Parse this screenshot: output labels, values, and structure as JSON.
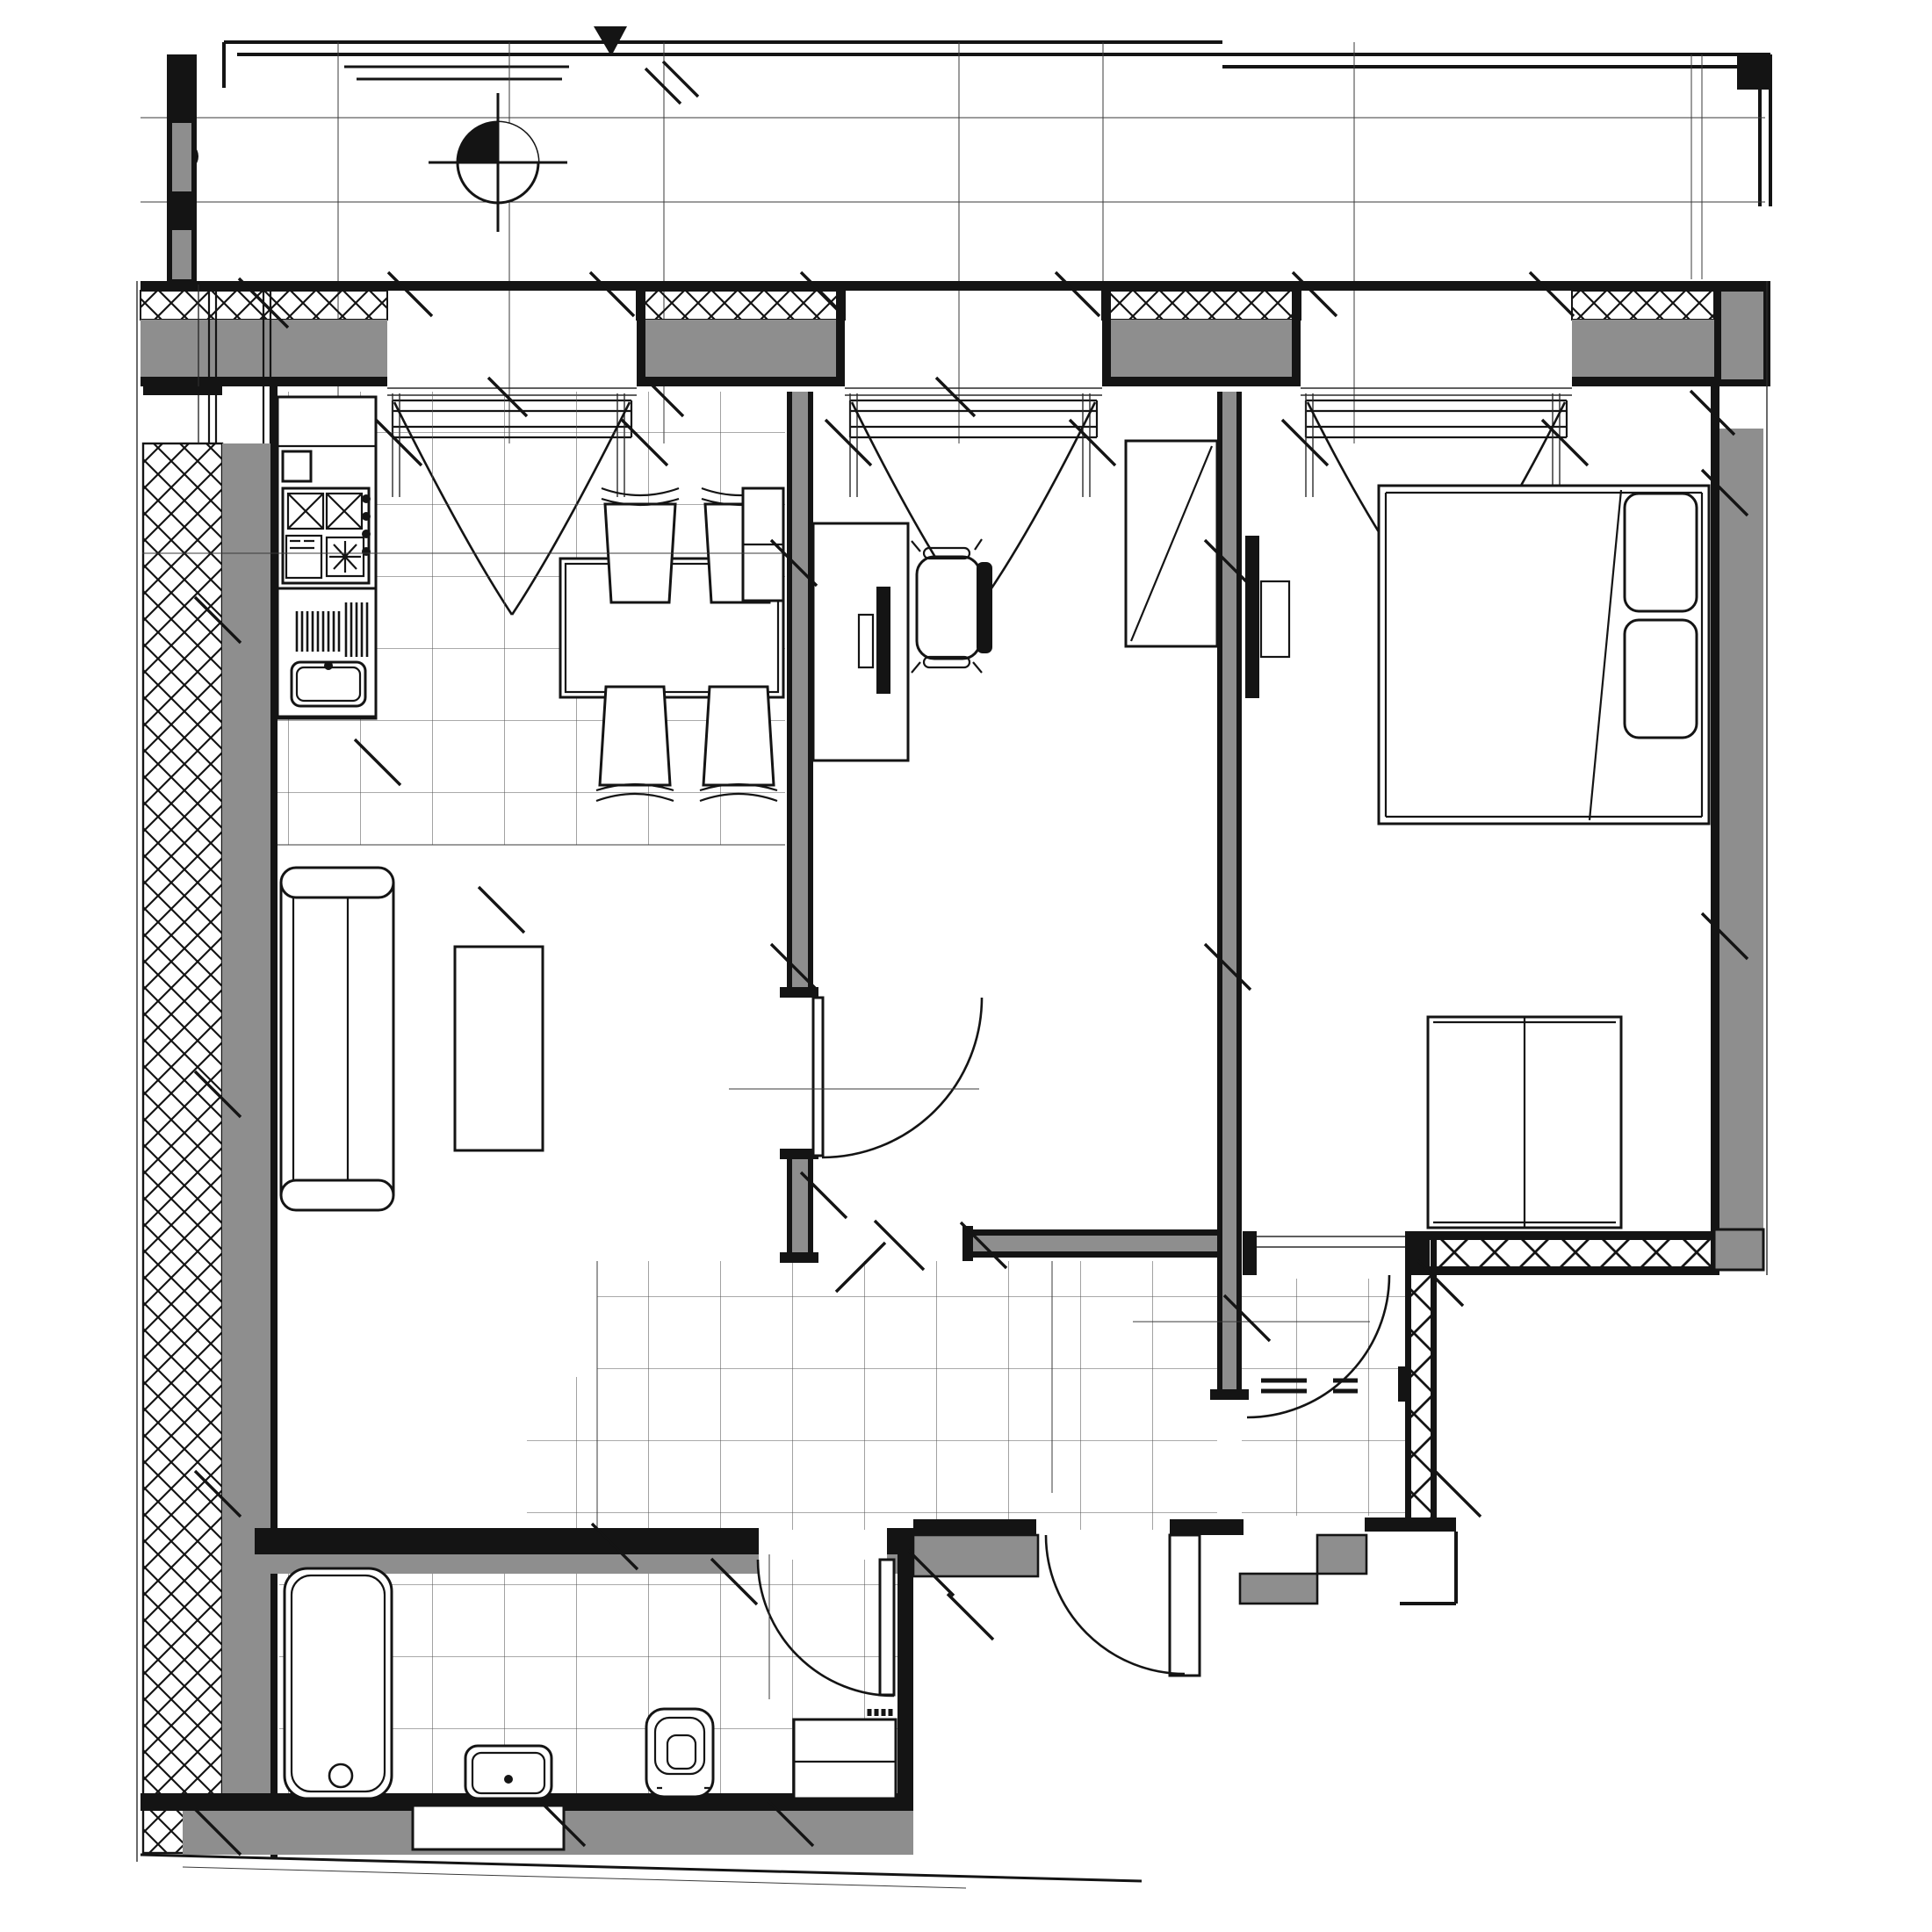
{
  "document": {
    "kind": "architectural-floor-plan",
    "style": "black-and-white CAD working drawing, plan view of a one-bedroom apartment with balcony",
    "visible_text": [],
    "colors": {
      "background": "#ffffff",
      "wall_line": "#141414",
      "wall_fill_gray": "#8e8e8e",
      "tile_grid_line": "#555555"
    },
    "legend_symbols": [
      {
        "name": "centroid-marker-symbol",
        "desc": "circle with opposite quadrants filled black, crosshair through center, on balcony"
      },
      {
        "name": "insulation-hatch",
        "desc": "cross (XX) hatch pattern inside exterior wall layers"
      },
      {
        "name": "curtain-swag",
        "desc": "V-shaped double arc hanging below each window"
      },
      {
        "name": "door-swing-arc",
        "desc": "quarter-circle arcs at every door"
      }
    ]
  },
  "rooms": [
    {
      "name": "balcony",
      "position": "top strip",
      "features": [
        "railing lines",
        "floor joint lines",
        "centroid-marker-symbol",
        "black flag marker"
      ]
    },
    {
      "name": "kitchen-dining",
      "position": "upper left",
      "floor": "tiled",
      "fixtures": [
        "kitchen counter",
        "cooktop with 2 crossed burners and knobs",
        "oven",
        "fan unit",
        "sink with drainboard",
        "dining table",
        "4 dining chairs",
        "sideboard"
      ]
    },
    {
      "name": "living-room",
      "position": "left middle",
      "floor": "plain",
      "fixtures": [
        "sofa with two armrests",
        "coffee table"
      ]
    },
    {
      "name": "study",
      "position": "center",
      "floor": "plain",
      "fixtures": [
        "desk",
        "monitor",
        "office chair",
        "cabinet with diagonal brace"
      ]
    },
    {
      "name": "bedroom",
      "position": "right",
      "floor": "plain",
      "fixtures": [
        "double bed with two pillows and folded blanket line",
        "wall TV with bracket",
        "wardrobe with divider"
      ]
    },
    {
      "name": "hallway",
      "position": "center bottom",
      "floor": "tiled",
      "fixtures": []
    },
    {
      "name": "entry-vestibule",
      "position": "lower right",
      "floor": "tiled",
      "fixtures": [
        "entry steps outside"
      ]
    },
    {
      "name": "bathroom",
      "position": "bottom left",
      "floor": "tiled",
      "fixtures": [
        "bathtub with drain",
        "washbasin",
        "toilet",
        "washing machine",
        "wall niche"
      ]
    }
  ],
  "doors": [
    {
      "name": "study-door",
      "wall": "living/study partition",
      "swing": "into study"
    },
    {
      "name": "bedroom-door",
      "wall": "bedroom bottom wall",
      "swing": "into vestibule"
    },
    {
      "name": "bathroom-door",
      "wall": "bathroom top wall",
      "swing": "into bathroom"
    },
    {
      "name": "entry-door",
      "wall": "hall bottom wall",
      "swing": "outward, leaf shown open"
    }
  ],
  "windows": [
    {
      "name": "window-1",
      "location": "top wall, above dining"
    },
    {
      "name": "window-2",
      "location": "top wall, above study"
    },
    {
      "name": "window-3",
      "location": "top wall, above bedroom"
    },
    {
      "name": "window-4",
      "location": "left wall, kitchen corner"
    }
  ]
}
